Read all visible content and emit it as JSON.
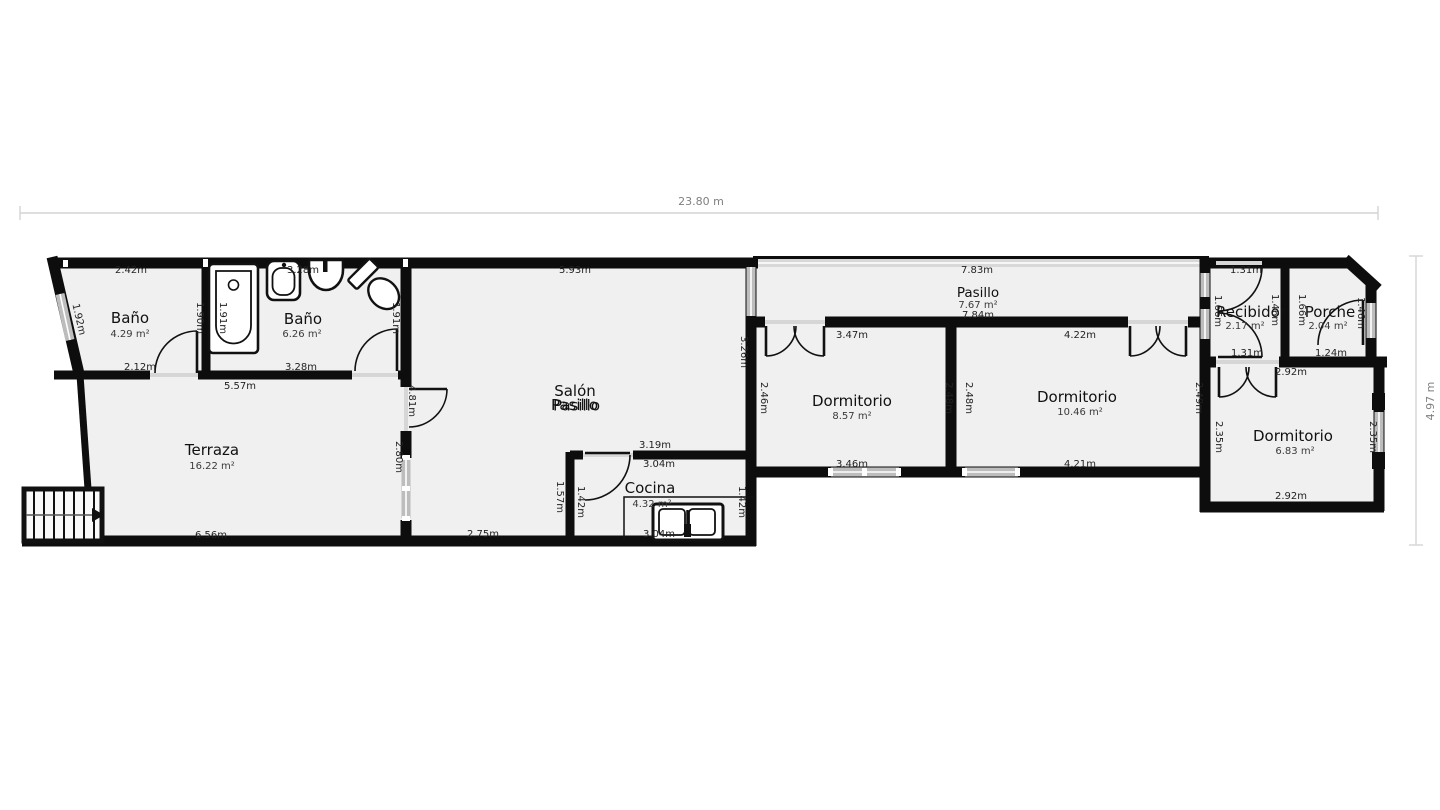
{
  "plan": {
    "overall_width": "23.80 m",
    "overall_height": "4.97 m",
    "rooms": {
      "bano1": {
        "name": "Baño",
        "area": "4.29 m²"
      },
      "bano2": {
        "name": "Baño",
        "area": "6.26 m²"
      },
      "terraza": {
        "name": "Terraza",
        "area": "16.22 m²"
      },
      "salon": {
        "name": "Salón"
      },
      "salon_overlay": {
        "name": "Pasillo"
      },
      "cocina": {
        "name": "Cocina",
        "area": "4.32 m²"
      },
      "pasillo": {
        "name": "Pasillo",
        "area": "7.67 m²"
      },
      "dormitorio1": {
        "name": "Dormitorio",
        "area": "8.57 m²"
      },
      "dormitorio2": {
        "name": "Dormitorio",
        "area": "10.46 m²"
      },
      "recibidor": {
        "name": "Recibidor",
        "area": "2.17 m²"
      },
      "porche": {
        "name": "Porche",
        "area": "2.04 m²"
      },
      "dormitorio3": {
        "name": "Dormitorio",
        "area": "6.83 m²"
      }
    },
    "dims": {
      "bano1_top": "2.42m",
      "bano1_left": "1.92m",
      "bano1_right": "1.90m",
      "bano1_bottom": "2.12m",
      "bano2_top": "3.28m",
      "bano2_left": "1.91m",
      "bano2_right": "1.91m",
      "bano2_bottom": "3.28m",
      "banos_bottom": "5.57m",
      "salon_top": "5.93m",
      "salon_right": "3.26m",
      "salon_bottom": "2.75m",
      "salon_door_left": "4.81m",
      "salon_window_left": "2.80m",
      "terraza_bottom": "6.56m",
      "cocina_top_out": "3.19m",
      "cocina_top_in": "3.04m",
      "cocina_left_out": "1.57m",
      "cocina_left_in": "1.42m",
      "cocina_right": "1.42m",
      "cocina_bottom": "3.04m",
      "pasillo_top": "7.83m",
      "pasillo_bottom": "7.84m",
      "dorm1_top": "3.47m",
      "dorm1_left": "2.46m",
      "dorm1_right": "2.48m",
      "dorm1_bottom": "3.46m",
      "dorm2_top": "4.22m",
      "dorm2_left": "2.48m",
      "dorm2_right": "2.49m",
      "dorm2_bottom": "4.21m",
      "recibidor_top": "1.31m",
      "recibidor_left": "1.66m",
      "recibidor_right": "1.46m",
      "recibidor_bottom": "1.31m",
      "porche_left": "1.66m",
      "porche_right": "1.46m",
      "porche_bottom": "1.24m",
      "dorm3_top": "2.92m",
      "dorm3_left": "2.35m",
      "dorm3_right": "2.35m",
      "dorm3_bottom": "2.92m"
    }
  }
}
